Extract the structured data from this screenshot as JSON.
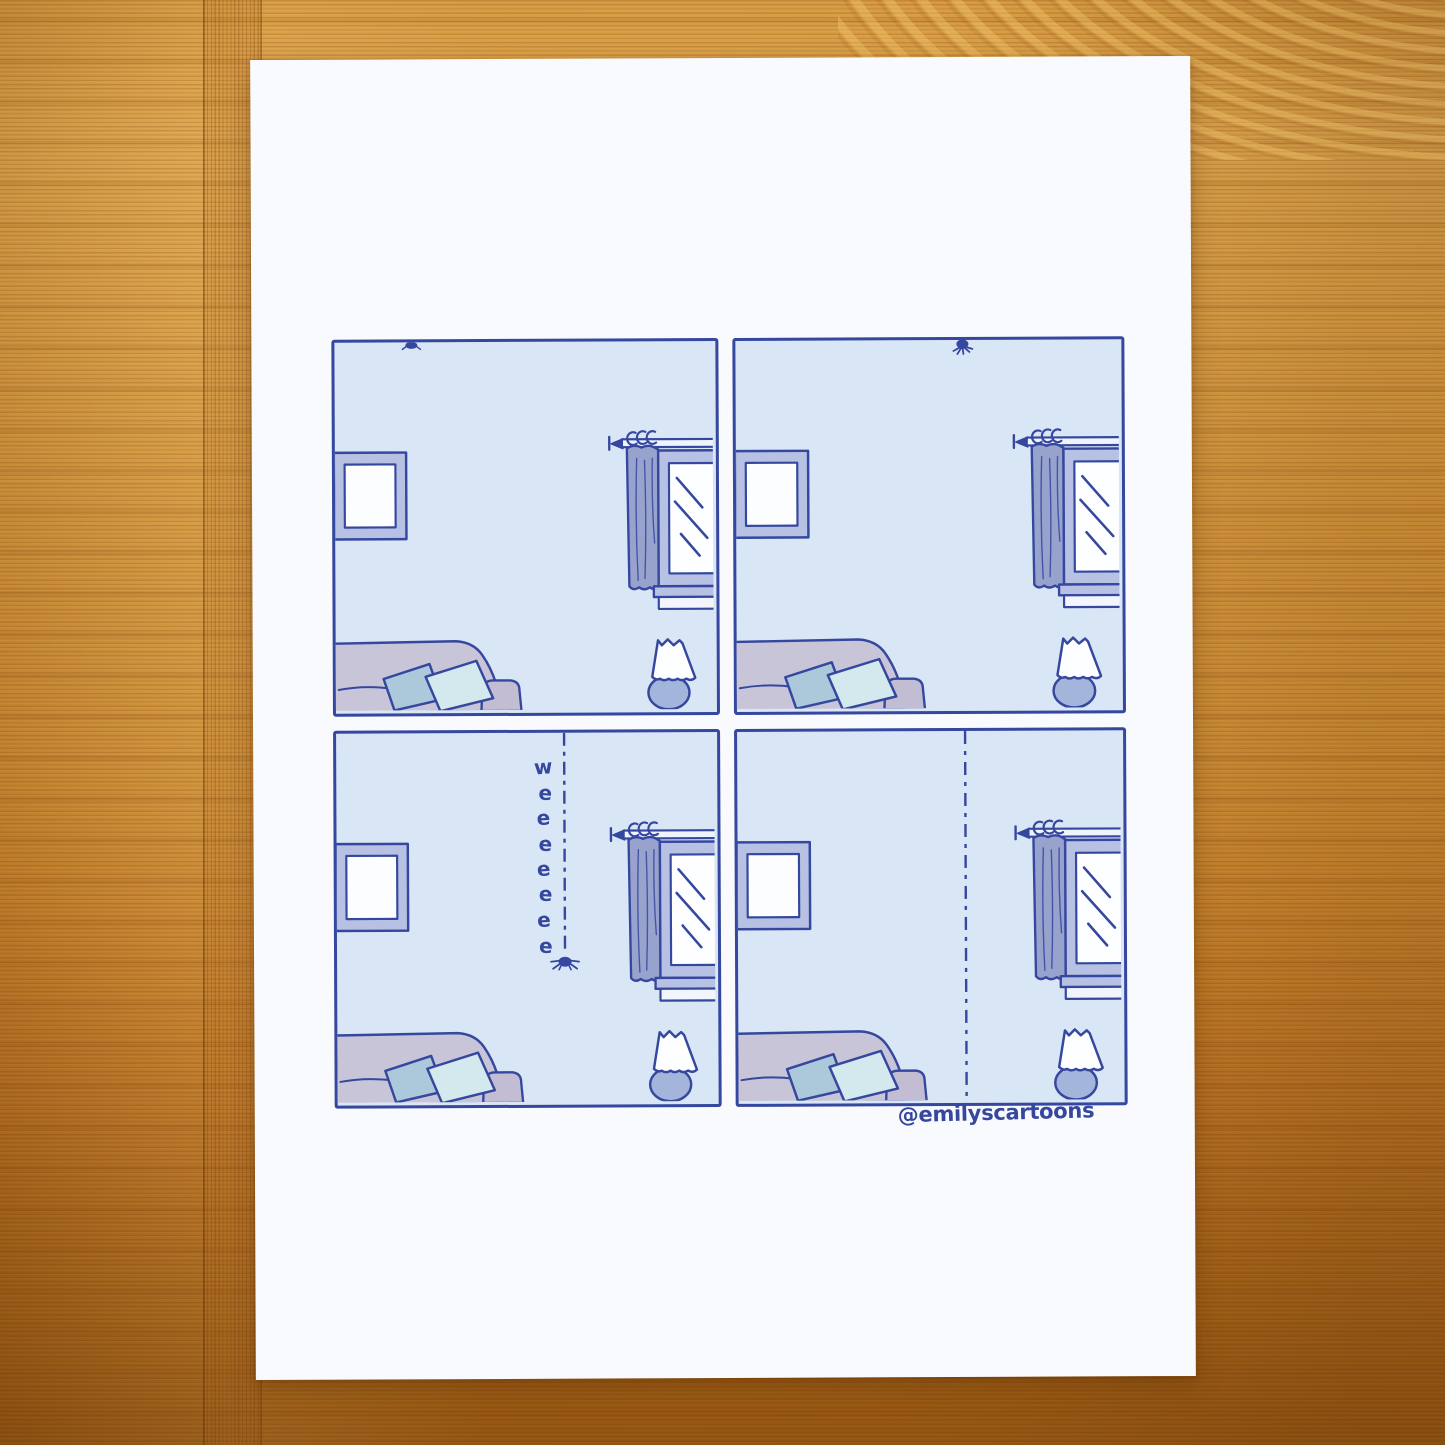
{
  "comic": {
    "signature": "@emilyscartoons",
    "sound_letters": [
      "w",
      "e",
      "e",
      "e",
      "e",
      "e",
      "e",
      "e"
    ],
    "sound_word": "weeeeeee",
    "panels": [
      {
        "id": 1,
        "depicts": "living room, tiny spider clinging to ceiling"
      },
      {
        "id": 2,
        "depicts": "living room, spider on ceiling with legs spread"
      },
      {
        "id": 3,
        "depicts": "spider sliding down silk thread",
        "sound_effect": "weeeeeee"
      },
      {
        "id": 4,
        "depicts": "empty silk thread hanging from ceiling"
      }
    ]
  },
  "colors": {
    "ink": "#35479e",
    "panel_background": "#d9e6f6",
    "periwinkle_frame": "#b6c1e3",
    "curtain": "#98a3cd",
    "couch": "#c9c5d8",
    "couch_armrest": "#c2bdd3",
    "pillow_left": "#abc9da",
    "pillow_right": "#d3e9ee",
    "lamp_base": "#a3b5da",
    "paper": "#f8fafd",
    "wood_light": "#dca44c",
    "wood_dark": "#9d5b12"
  }
}
